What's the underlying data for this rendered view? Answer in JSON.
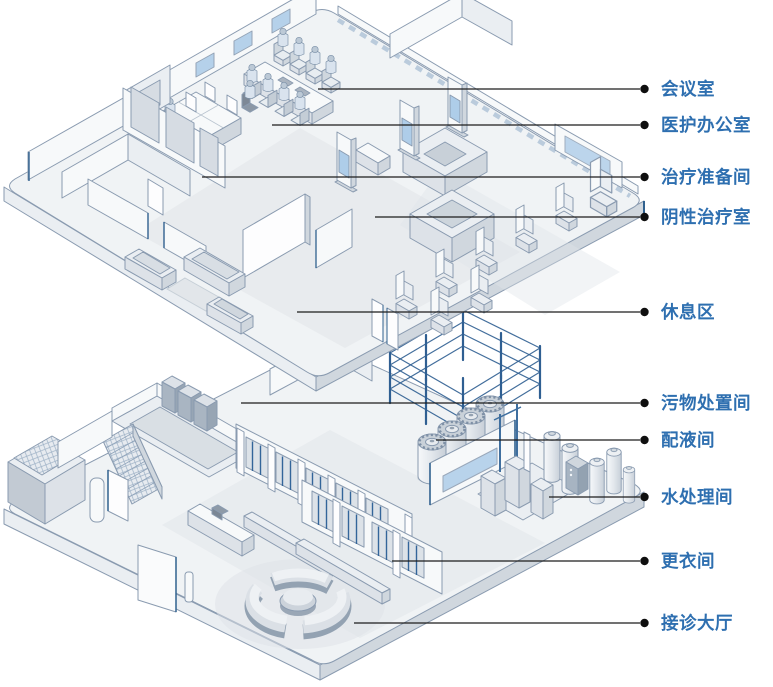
{
  "figure": {
    "description": "Isometric cutaway illustration of a two-storey clinic building: an upper treatment floor and a lower ground floor, with callout labels for each room.",
    "upper_floor_rooms": [
      "会议室",
      "医护办公室",
      "治疗准备间",
      "阴性治疗室",
      "休息区"
    ],
    "lower_floor_rooms": [
      "污物处置间",
      "配液间",
      "水处理间",
      "更衣间",
      "接诊大厅"
    ]
  },
  "callouts": [
    {
      "id": "conference-room",
      "label": "会议室",
      "line_y": 89,
      "line_x1": 318
    },
    {
      "id": "medical-office",
      "label": "医护办公室",
      "line_y": 125,
      "line_x1": 272
    },
    {
      "id": "treatment-prep-room",
      "label": "治疗准备间",
      "line_y": 177,
      "line_x1": 202
    },
    {
      "id": "negative-treatment-room",
      "label": "阴性治疗室",
      "line_y": 217,
      "line_x1": 375
    },
    {
      "id": "rest-area",
      "label": "休息区",
      "line_y": 312,
      "line_x1": 297
    },
    {
      "id": "waste-disposal-room",
      "label": "污物处置间",
      "line_y": 403,
      "line_x1": 241
    },
    {
      "id": "liquid-prep-room",
      "label": "配液间",
      "line_y": 440,
      "line_x1": 436
    },
    {
      "id": "water-treatment-room",
      "label": "水处理间",
      "line_y": 497,
      "line_x1": 549
    },
    {
      "id": "changing-room",
      "label": "更衣间",
      "line_y": 561,
      "line_x1": 392
    },
    {
      "id": "reception-hall",
      "label": "接诊大厅",
      "line_y": 623,
      "line_x1": 354
    }
  ],
  "style": {
    "label_color": "#2E6FB0",
    "line_color": "#1c1c1c",
    "dot_color": "#0f0f0f",
    "dot_x": 644.5,
    "line_x2": 640,
    "label_x": 661,
    "background": "#ffffff"
  }
}
